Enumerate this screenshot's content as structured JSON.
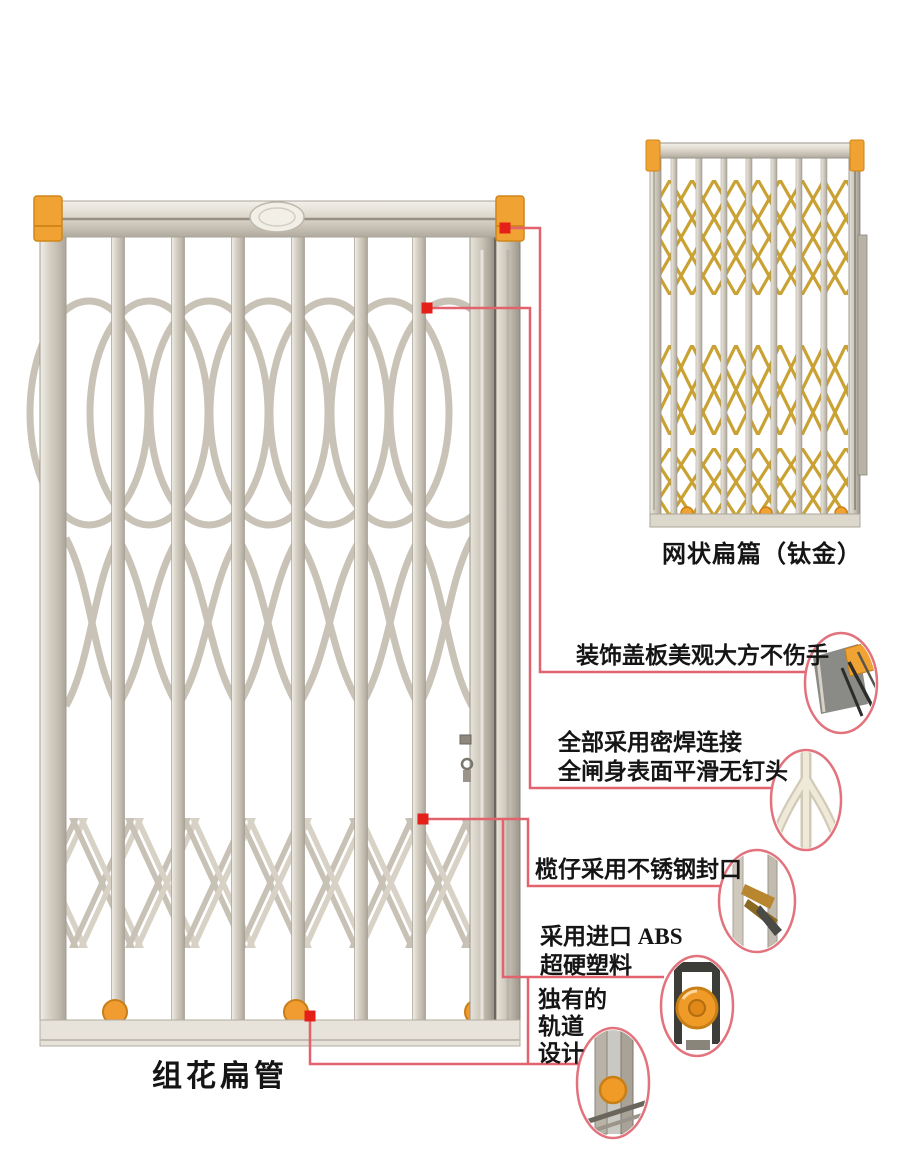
{
  "product": {
    "main_caption": "组花扁管",
    "small_caption": "网状扁篇（钛金）"
  },
  "callouts": [
    {
      "name": "decorative-cover-plate",
      "lines": [
        "装饰盖板美观大方不伤手"
      ]
    },
    {
      "name": "sealed-welding",
      "lines": [
        "全部采用密焊连接",
        "全闸身表面平滑无钉头"
      ]
    },
    {
      "name": "stainless-steel-seal",
      "lines": [
        "榄仔采用不锈钢封口"
      ]
    },
    {
      "name": "abs-plastic",
      "lines": [
        "采用进口 ABS",
        "超硬塑料"
      ]
    },
    {
      "name": "unique-track-design",
      "lines": [
        "独有的",
        "轨道",
        "设计"
      ]
    }
  ],
  "colors": {
    "annotation_line": "#e2636e",
    "marker": "#e42019",
    "detail_ring": "#e2737d",
    "cap_orange": "#f0a232",
    "gold": "#c9a233",
    "metal": "#d5cfc3"
  }
}
